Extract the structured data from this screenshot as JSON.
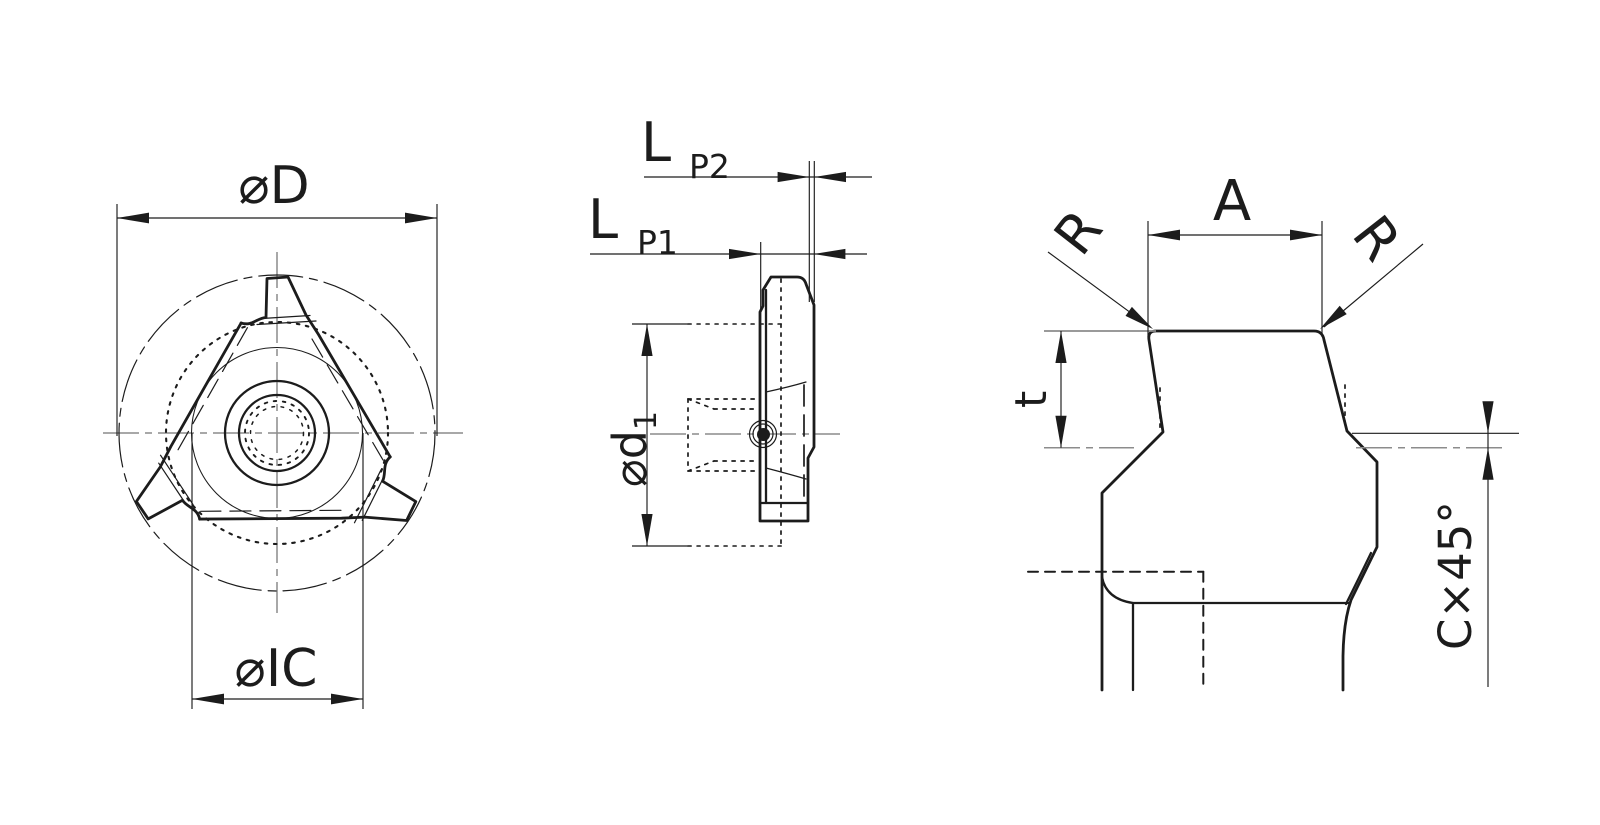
{
  "figure": {
    "kind": "technical-drawing",
    "subject": "triangular threading insert, three orthographic/detail views"
  },
  "colors": {
    "line": "#1c1c1c",
    "centerline": "#8c8c8c",
    "background": "#ffffff"
  },
  "labels": {
    "top_view": {
      "outer_diameter": "⌀D",
      "inscribed_circle": "⌀IC"
    },
    "side_view": {
      "pitch2_main": "L",
      "pitch2_sub": "P2",
      "pitch1_main": "L",
      "pitch1_sub": "P1",
      "bore_main": "⌀d",
      "bore_sub": "1"
    },
    "profile_view": {
      "width": "A",
      "radius_left": "R",
      "radius_right": "R",
      "depth": "t",
      "chamfer": "C×45°"
    }
  }
}
